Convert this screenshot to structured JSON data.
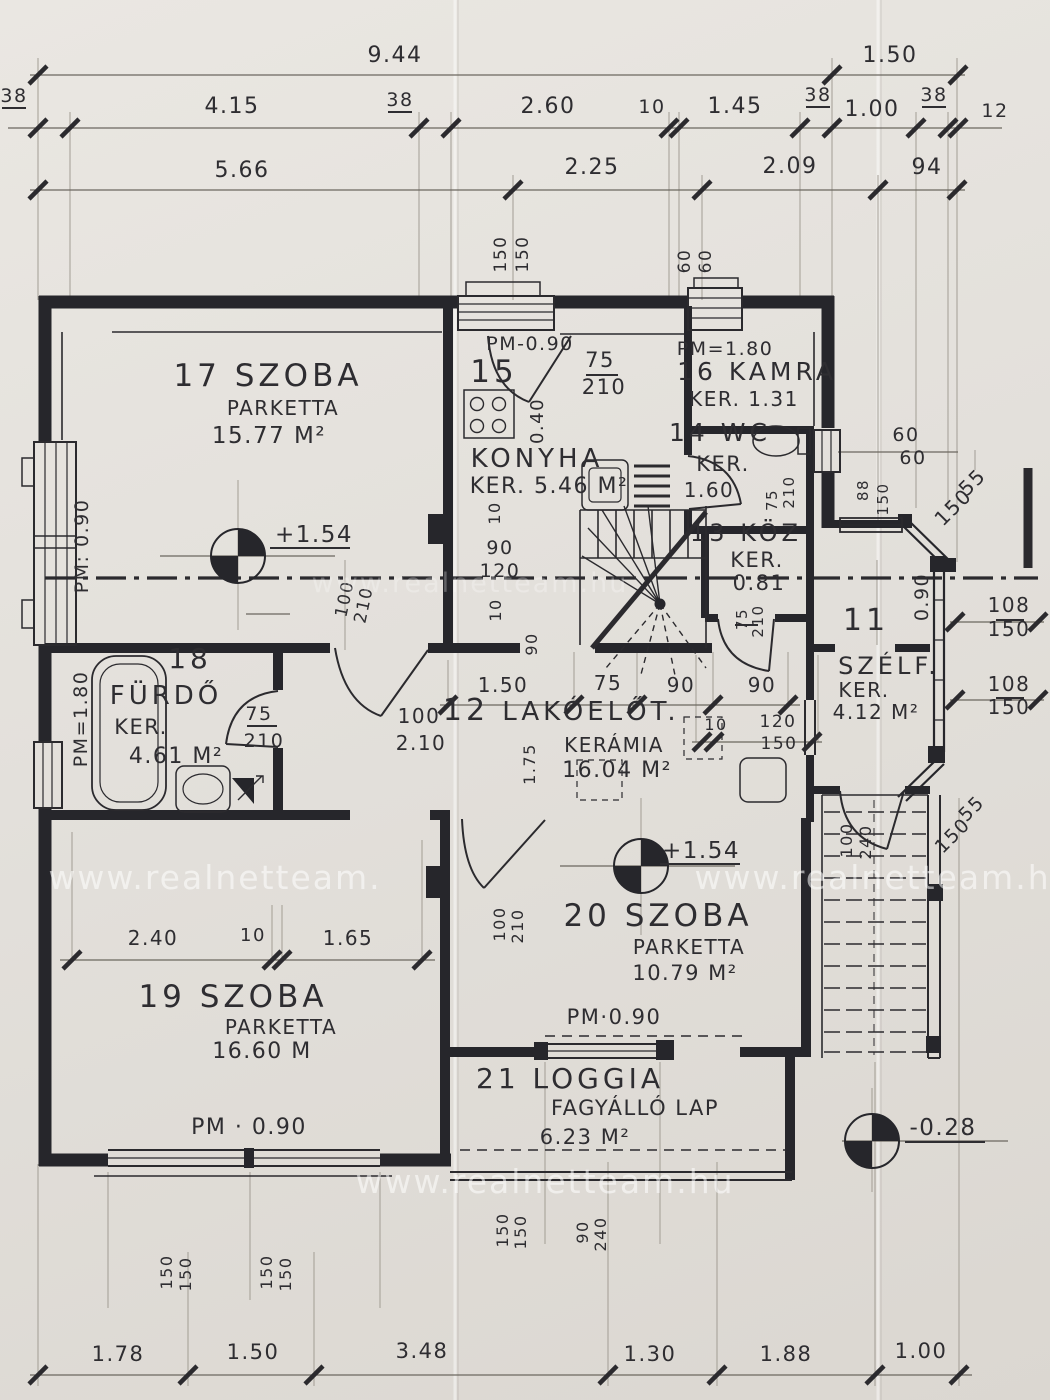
{
  "document": {
    "type": "scanned architectural floor plan",
    "language": "Hungarian",
    "watermark": "www.realnetteam.hu"
  },
  "palette": {
    "paper": "#e3e0db",
    "ink": "#2b2a2e",
    "dim_line": "#6b675f",
    "witness": "#a29d94",
    "watermark": "rgba(255,255,255,0.55)"
  },
  "rooms": [
    {
      "num": "11",
      "name": "SZÉLF.",
      "floor": "KER.",
      "area": "4.12 M²"
    },
    {
      "num": "12",
      "name": "LAKÓELŐT.",
      "floor": "KERÁMIA",
      "area": "16.04 M²"
    },
    {
      "num": "13",
      "name": "KÖZ",
      "floor": "KER.",
      "area": "0.81"
    },
    {
      "num": "14",
      "name": "WC",
      "floor": "KER.",
      "area": "1.60"
    },
    {
      "num": "15",
      "name": "KONYHA",
      "floor": "KER.",
      "area": "5.46 M²"
    },
    {
      "num": "16",
      "name": "KAMRA",
      "floor": "KER.",
      "area": "1.31"
    },
    {
      "num": "17",
      "name": "SZOBA",
      "floor": "PARKETTA",
      "area": "15.77 M²"
    },
    {
      "num": "18",
      "name": "FÜRDŐ",
      "floor": "KER.",
      "area": "4.61 M²"
    },
    {
      "num": "19",
      "name": "SZOBA",
      "floor": "PARKETTA",
      "area": "16.60 M"
    },
    {
      "num": "20",
      "name": "SZOBA",
      "floor": "PARKETTA",
      "area": "10.79 M²"
    },
    {
      "num": "21",
      "name": "LOGGIA",
      "floor": "FAGYÁLLÓ LAP",
      "area": "6.23 M²"
    }
  ],
  "level_markers": [
    "+1.54",
    "+1.54",
    "-0.28"
  ],
  "parapet_labels": [
    "PM: 0.90",
    "PM-0.90",
    "PM=1.80",
    "PM=1.80",
    "PM·0.90",
    "PM · 0.90"
  ],
  "dimension_chains": {
    "top_row_1": [
      "9.44",
      "1.50"
    ],
    "top_row_2": [
      "38",
      "4.15",
      "38",
      "2.60",
      "10",
      "1.45",
      "38",
      "1.00",
      "38",
      "12"
    ],
    "top_row_3": [
      "5.66",
      "2.25",
      "2.09",
      "94"
    ],
    "hall_row": [
      "1.50",
      "75",
      "90",
      "90"
    ],
    "room19_row": [
      "2.40",
      "10",
      "1.65"
    ],
    "bottom_row": [
      "1.78",
      "1.50",
      "3.48",
      "1.30",
      "1.88",
      "1.00"
    ],
    "openings": [
      "100/210",
      "75/210",
      "75/210",
      "75/210",
      "75/210",
      "100/240",
      "100/210",
      "100/2.10",
      "90/240"
    ],
    "windows": [
      "150/150",
      "150/150",
      "60/60",
      "60/60",
      "88/150",
      "55/150",
      "108/150",
      "108/150",
      "55/150",
      "120/150",
      "90/120",
      "150/150",
      "150/150",
      "150/150"
    ]
  },
  "annotations": [
    [
      395,
      62,
      0,
      22,
      "9.44"
    ],
    [
      890,
      62,
      0,
      22,
      "1.50"
    ],
    [
      14,
      102,
      0,
      19,
      "38"
    ],
    [
      232,
      113,
      0,
      22,
      "4.15"
    ],
    [
      400,
      106,
      0,
      19,
      "38"
    ],
    [
      548,
      113,
      0,
      22,
      "2.60"
    ],
    [
      652,
      113,
      0,
      19,
      "10"
    ],
    [
      735,
      113,
      0,
      22,
      "1.45"
    ],
    [
      818,
      101,
      0,
      19,
      "38"
    ],
    [
      872,
      116,
      0,
      22,
      "1.00"
    ],
    [
      934,
      101,
      0,
      19,
      "38"
    ],
    [
      995,
      117,
      0,
      19,
      "12"
    ],
    [
      242,
      177,
      0,
      22,
      "5.66"
    ],
    [
      592,
      174,
      0,
      22,
      "2.25"
    ],
    [
      790,
      173,
      0,
      22,
      "2.09"
    ],
    [
      927,
      174,
      0,
      22,
      "94"
    ],
    [
      506,
      254,
      -90,
      17,
      "150"
    ],
    [
      528,
      254,
      -90,
      17,
      "150"
    ],
    [
      690,
      261,
      -90,
      17,
      "60"
    ],
    [
      711,
      261,
      -90,
      17,
      "60"
    ],
    [
      268,
      386,
      0,
      31,
      "17  SZOBA",
      "rm"
    ],
    [
      283,
      415,
      0,
      20,
      "PARKETTA"
    ],
    [
      269,
      443,
      0,
      23,
      "15.77 M²"
    ],
    [
      88,
      546,
      -90,
      19,
      "PM: 0.90"
    ],
    [
      314,
      542,
      0,
      23,
      "+1.54"
    ],
    [
      350,
      600,
      -78,
      17,
      "100"
    ],
    [
      369,
      606,
      -78,
      17,
      "210"
    ],
    [
      530,
      350,
      0,
      19,
      "PM-0.90"
    ],
    [
      494,
      382,
      0,
      31,
      "15",
      "rm"
    ],
    [
      600,
      367,
      0,
      21,
      "75"
    ],
    [
      604,
      394,
      0,
      21,
      "210"
    ],
    [
      543,
      421,
      -90,
      18,
      "0.40"
    ],
    [
      537,
      467,
      0,
      26,
      "KONYHA",
      "rm"
    ],
    [
      549,
      493,
      0,
      22,
      "KER. 5.46 M²"
    ],
    [
      500,
      513,
      -90,
      16,
      "10"
    ],
    [
      500,
      554,
      0,
      19,
      "90"
    ],
    [
      500,
      577,
      0,
      19,
      "120"
    ],
    [
      501,
      610,
      -90,
      16,
      "10"
    ],
    [
      537,
      644,
      -90,
      16,
      "90"
    ],
    [
      725,
      355,
      0,
      19,
      "PM=1.80"
    ],
    [
      757,
      380,
      0,
      25,
      "16 KAMRA",
      "rm"
    ],
    [
      744,
      406,
      0,
      20,
      "KER. 1.31"
    ],
    [
      720,
      441,
      0,
      25,
      "14 WC",
      "rm"
    ],
    [
      723,
      471,
      0,
      21,
      "KER."
    ],
    [
      709,
      497,
      0,
      20,
      "1.60"
    ],
    [
      777,
      500,
      -90,
      15,
      "75"
    ],
    [
      794,
      492,
      -90,
      15,
      "210"
    ],
    [
      746,
      541,
      0,
      24,
      "13 KÖZ",
      "rm"
    ],
    [
      757,
      567,
      0,
      21,
      "KER."
    ],
    [
      759,
      590,
      0,
      21,
      "0.81"
    ],
    [
      747,
      619,
      -90,
      15,
      "75"
    ],
    [
      763,
      621,
      -90,
      15,
      "210"
    ],
    [
      868,
      490,
      -90,
      15,
      "88"
    ],
    [
      888,
      499,
      -90,
      15,
      "150"
    ],
    [
      906,
      441,
      0,
      19,
      "60"
    ],
    [
      913,
      464,
      0,
      19,
      "60"
    ],
    [
      977,
      487,
      -45,
      20,
      "55"
    ],
    [
      958,
      512,
      -45,
      20,
      "150"
    ],
    [
      928,
      597,
      -90,
      19,
      "0.90"
    ],
    [
      1009,
      612,
      0,
      20,
      "108"
    ],
    [
      1009,
      636,
      0,
      20,
      "150"
    ],
    [
      866,
      630,
      0,
      30,
      "11",
      "rm"
    ],
    [
      889,
      674,
      0,
      24,
      "SZÉLF.",
      "rm"
    ],
    [
      864,
      697,
      0,
      20,
      "KER."
    ],
    [
      876,
      719,
      0,
      20,
      "4.12 M²"
    ],
    [
      1009,
      691,
      0,
      20,
      "108"
    ],
    [
      1009,
      714,
      0,
      20,
      "150"
    ],
    [
      190,
      668,
      0,
      28,
      "18",
      "rm"
    ],
    [
      166,
      704,
      0,
      26,
      "FÜRDŐ",
      "rm"
    ],
    [
      141,
      734,
      0,
      21,
      "KER."
    ],
    [
      176,
      763,
      0,
      22,
      "4.61 M²"
    ],
    [
      87,
      719,
      -90,
      19,
      "PM=1.80"
    ],
    [
      259,
      720,
      0,
      19,
      "75"
    ],
    [
      264,
      747,
      0,
      19,
      "210"
    ],
    [
      503,
      692,
      0,
      20,
      "1.50"
    ],
    [
      608,
      690,
      0,
      20,
      "75"
    ],
    [
      681,
      692,
      0,
      20,
      "90"
    ],
    [
      762,
      692,
      0,
      20,
      "90"
    ],
    [
      419,
      723,
      0,
      20,
      "100"
    ],
    [
      421,
      750,
      0,
      20,
      "2.10"
    ],
    [
      466,
      720,
      0,
      30,
      "12",
      "rm"
    ],
    [
      591,
      720,
      0,
      26,
      "LAKÓELŐT.",
      "rm"
    ],
    [
      716,
      730,
      0,
      16,
      "10"
    ],
    [
      778,
      727,
      0,
      17,
      "120"
    ],
    [
      779,
      749,
      0,
      17,
      "150"
    ],
    [
      535,
      764,
      -90,
      16,
      "1.75"
    ],
    [
      614,
      752,
      0,
      20,
      "KERÁMIA"
    ],
    [
      617,
      777,
      0,
      22,
      "16.04 M²"
    ],
    [
      701,
      858,
      0,
      23,
      "+1.54"
    ],
    [
      852,
      840,
      -90,
      16,
      "100"
    ],
    [
      871,
      842,
      -90,
      16,
      "240"
    ],
    [
      976,
      813,
      -45,
      19,
      "55"
    ],
    [
      957,
      840,
      -45,
      19,
      "150"
    ],
    [
      153,
      945,
      0,
      20,
      "2.40"
    ],
    [
      253,
      941,
      0,
      18,
      "10"
    ],
    [
      348,
      945,
      0,
      20,
      "1.65"
    ],
    [
      233,
      1007,
      0,
      31,
      "19  SZOBA",
      "rm"
    ],
    [
      281,
      1034,
      0,
      20,
      "PARKETTA"
    ],
    [
      262,
      1058,
      0,
      22,
      "16.60 M"
    ],
    [
      249,
      1134,
      0,
      22,
      "PM · 0.90"
    ],
    [
      505,
      924,
      -90,
      16,
      "100"
    ],
    [
      523,
      926,
      -90,
      16,
      "210"
    ],
    [
      658,
      926,
      0,
      31,
      "20  SZOBA",
      "rm"
    ],
    [
      689,
      954,
      0,
      20,
      "PARKETTA"
    ],
    [
      685,
      980,
      0,
      21,
      "10.79 M²"
    ],
    [
      614,
      1024,
      0,
      21,
      "PM·0.90"
    ],
    [
      570,
      1088,
      0,
      28,
      "21  LOGGIA",
      "rm"
    ],
    [
      635,
      1115,
      0,
      21,
      "FAGYÁLLÓ LAP"
    ],
    [
      585,
      1144,
      0,
      21,
      "6.23 M²"
    ],
    [
      943,
      1135,
      0,
      23,
      "-0.28"
    ],
    [
      172,
      1272,
      -90,
      16,
      "150"
    ],
    [
      191,
      1274,
      -90,
      16,
      "150"
    ],
    [
      272,
      1272,
      -90,
      16,
      "150"
    ],
    [
      291,
      1274,
      -90,
      16,
      "150"
    ],
    [
      508,
      1230,
      -90,
      16,
      "150"
    ],
    [
      526,
      1232,
      -90,
      16,
      "150"
    ],
    [
      588,
      1232,
      -90,
      16,
      "90"
    ],
    [
      606,
      1234,
      -90,
      16,
      "240"
    ],
    [
      118,
      1361,
      0,
      21,
      "1.78"
    ],
    [
      253,
      1359,
      0,
      21,
      "1.50"
    ],
    [
      422,
      1358,
      0,
      21,
      "3.48"
    ],
    [
      650,
      1361,
      0,
      21,
      "1.30"
    ],
    [
      786,
      1361,
      0,
      21,
      "1.88"
    ],
    [
      921,
      1358,
      0,
      21,
      "1.00"
    ],
    [
      215,
      889,
      0,
      33,
      "www.realnetteam.",
      "wm"
    ],
    [
      884,
      889,
      0,
      33,
      "www.realnetteam.hu",
      "wm"
    ],
    [
      545,
      1193,
      0,
      33,
      "www.realnetteam.hu",
      "wm"
    ],
    [
      470,
      592,
      0,
      27,
      "www.realnetteam.hu",
      "wm2"
    ]
  ]
}
